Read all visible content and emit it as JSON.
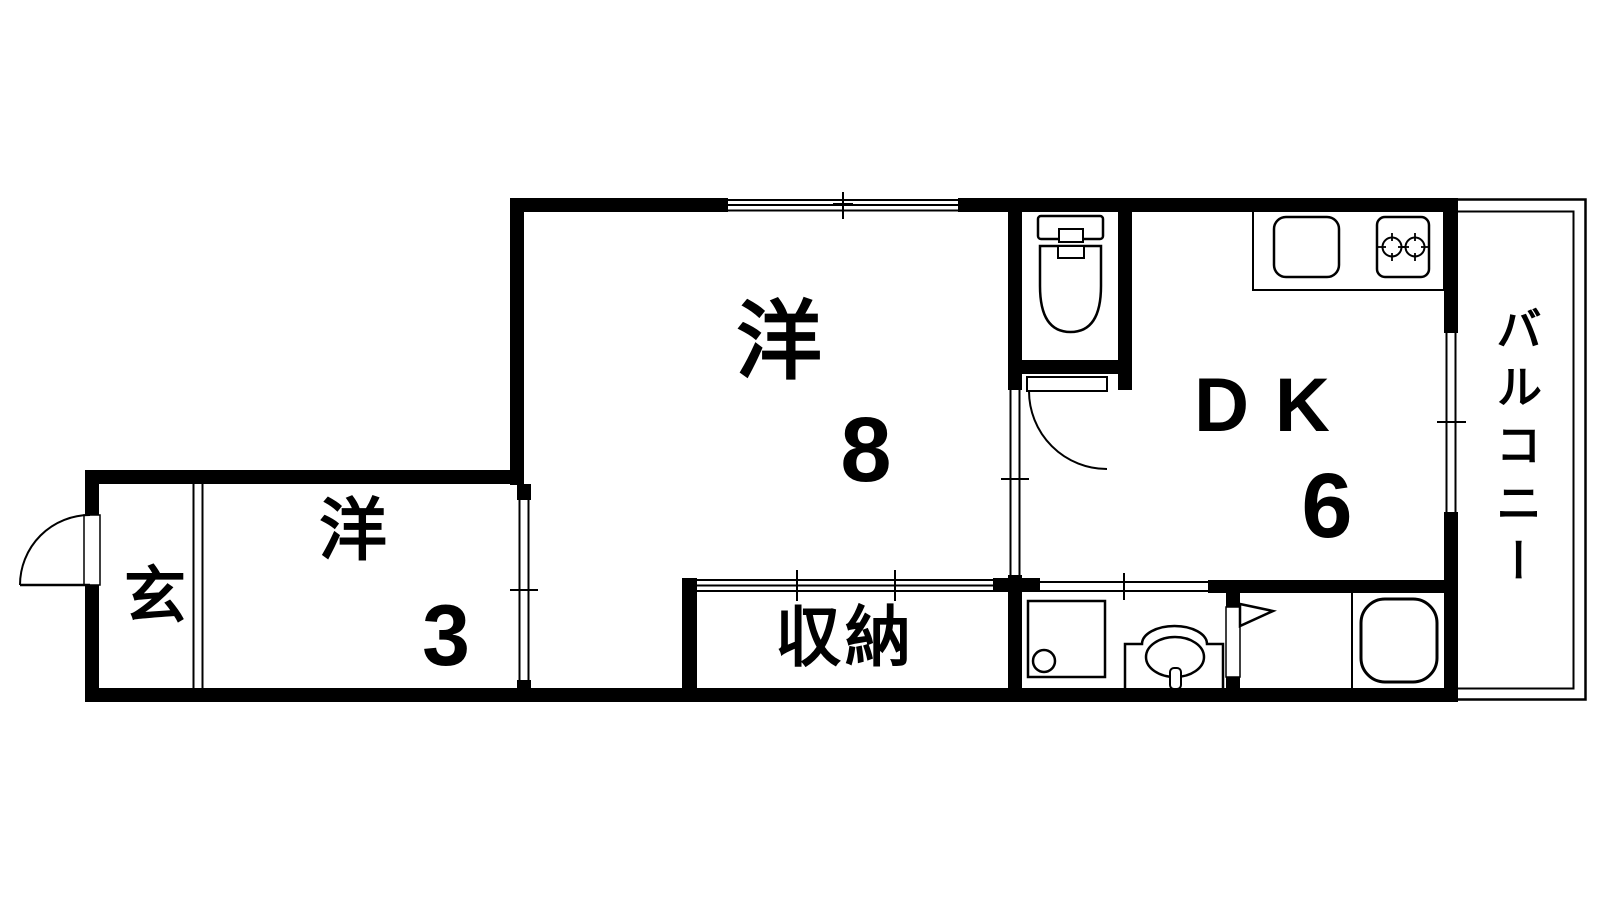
{
  "plan": {
    "background_color": "#ffffff",
    "wall_color": "#000000",
    "line_color": "#000000",
    "rooms": {
      "western_room_8": {
        "name": "洋",
        "size": "8"
      },
      "western_room_3": {
        "name": "洋",
        "size": "3"
      },
      "dining_kitchen": {
        "name": "DK",
        "size": "6"
      },
      "entrance": {
        "name": "玄"
      },
      "storage": {
        "name": "収納"
      },
      "balcony": {
        "name": "バルコニー"
      }
    },
    "fixtures": {
      "toilet": "toilet-icon",
      "kitchen_sink": "kitchen-sink-icon",
      "stove": "two-burner-stove-icon",
      "washing_machine_pan": "washing-machine-pan-icon",
      "washbasin": "washbasin-icon",
      "bathtub": "bathtub-icon",
      "entrance_door": "entrance-swing-door-icon",
      "toilet_door": "toilet-swing-door-icon",
      "bathroom_door": "bathroom-folding-door-icon"
    }
  }
}
